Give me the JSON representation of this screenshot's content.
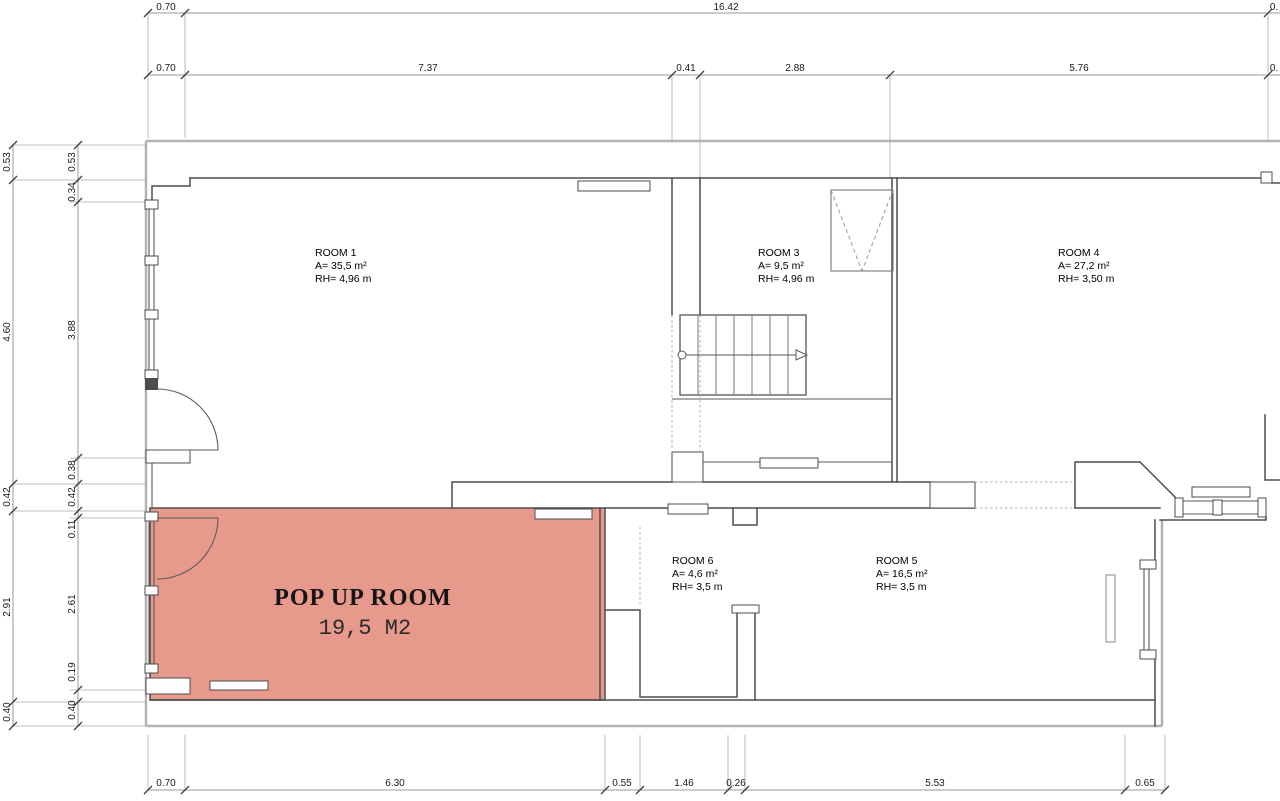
{
  "plan": {
    "popup_room": {
      "name": "POP UP ROOM",
      "area": "19,5 M2"
    },
    "rooms": [
      {
        "name": "ROOM 1",
        "area": "A= 35,5 m²",
        "height": "RH= 4,96 m"
      },
      {
        "name": "ROOM 3",
        "area": "A= 9,5 m²",
        "height": "RH= 4,96 m"
      },
      {
        "name": "ROOM 4",
        "area": "A= 27,2 m²",
        "height": "RH= 3,50 m"
      },
      {
        "name": "ROOM 6",
        "area": "A= 4,6 m²",
        "height": "RH= 3,5 m"
      },
      {
        "name": "ROOM 5",
        "area": "A= 16,5 m²",
        "height": "RH= 3,5 m"
      }
    ],
    "dimensions": {
      "top_row1": [
        "0.70",
        "16.42",
        "0."
      ],
      "top_row2": [
        "0.70",
        "7.37",
        "0.41",
        "2.88",
        "5.76",
        "0."
      ],
      "left_outer": [
        "0.53",
        "4.60",
        "0.42",
        "2.91",
        "0.40"
      ],
      "left_inner": [
        "0.53",
        "0.34",
        "3.88",
        "0.38",
        "0.42",
        "0.11",
        "2.61",
        "0.19",
        "0.40"
      ],
      "bottom": [
        "0.70",
        "6.30",
        "0.55",
        "1.46",
        "0.26",
        "5.53",
        "0.65"
      ]
    },
    "colors": {
      "highlight": "#e7998c",
      "wall": "#4d4d4d",
      "outer_wall": "#b3b3b3",
      "dimension": "#9a9a9a"
    }
  }
}
